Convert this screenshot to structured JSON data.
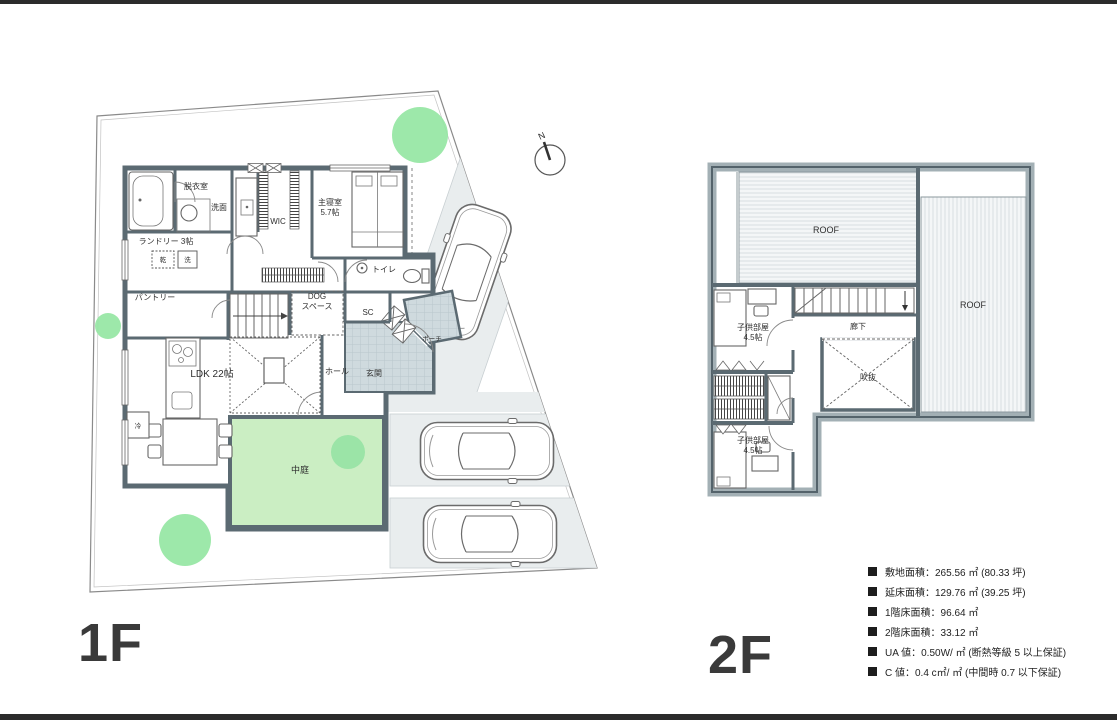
{
  "document": {
    "type": "house-floor-plan",
    "floor1_label": "1F",
    "floor2_label": "2F",
    "compass_label": "N"
  },
  "floor1": {
    "labels": {
      "dressing": "脱衣室",
      "washroom": "洗面",
      "wic": "WIC",
      "master_bedroom": "主寝室",
      "master_bedroom_size": "5.7帖",
      "laundry": "ランドリー 3帖",
      "dryer": "乾",
      "washer": "洗",
      "pantry": "パントリー",
      "dog_space_1": "DOG",
      "dog_space_2": "スペース",
      "toilet": "トイレ",
      "shoe_closet": "SC",
      "hall": "ホール",
      "entrance": "玄関",
      "porch": "ポーチ",
      "ldk": "LDK 22帖",
      "fridge": "冷",
      "courtyard": "中庭"
    }
  },
  "floor2": {
    "labels": {
      "roof_left": "ROOF",
      "roof_right": "ROOF",
      "kids_room1_1": "子供部屋",
      "kids_room1_2": "4.5帖",
      "corridor": "廊下",
      "void": "吹抜",
      "kids_room2_1": "子供部屋",
      "kids_room2_2": "4.5帖"
    }
  },
  "specs": {
    "items": [
      "敷地面積：265.56 ㎡ (80.33 坪)",
      "延床面積：129.76 ㎡ (39.25 坪)",
      "1階床面積：96.64 ㎡",
      "2階床面積：33.12 ㎡",
      "UA 値：0.50W/ ㎡ (断熱等級 5 以上保証)",
      "C 値：0.4 c㎡/ ㎡ (中間時 0.7 以下保証)"
    ]
  },
  "colors": {
    "wall": "#5b6a72",
    "paving": "#e9edee",
    "courtyard_green": "#cbeec3",
    "tree_green": "#92e5a1",
    "entrance_tile": "#cfdade",
    "roof_stripe": "#d9dee0",
    "frame": "#2b2b2b",
    "floor_label_text": "#3a3a3a"
  }
}
